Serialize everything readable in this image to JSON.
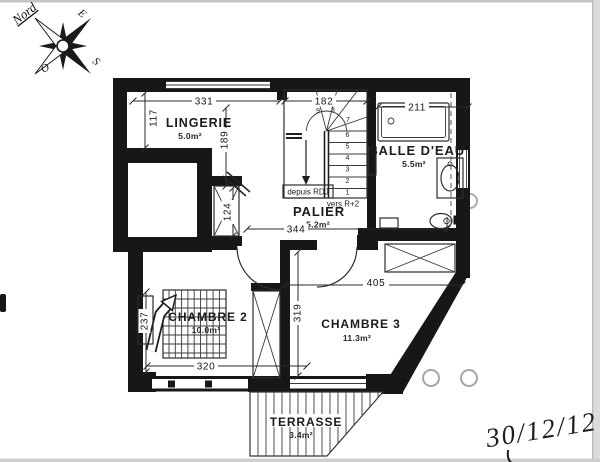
{
  "compass": {
    "north": "Nord",
    "east": "E",
    "south": "S",
    "west": "O"
  },
  "rooms": {
    "lingerie": {
      "name": "LINGERIE",
      "area": "5.0m²"
    },
    "salle_eau": {
      "name": "SALLE D'EAU",
      "area": "5.5m²"
    },
    "palier": {
      "name": "PALIER",
      "area": "5.2m²"
    },
    "chambre2": {
      "name": "CHAMBRE 2",
      "area": "10.0m²"
    },
    "chambre3": {
      "name": "CHAMBRE 3",
      "area": "11.3m²"
    },
    "terrasse": {
      "name": "TERRASSE",
      "area": "3.4m²"
    }
  },
  "dims": {
    "lingerie_width": "331",
    "lingerie_left": "117",
    "lingerie_right": "189",
    "stairs_width": "182",
    "shower_width": "211",
    "duct_height": "124",
    "palier_width": "344",
    "chambre3_width": "405",
    "chambre3_height": "319",
    "chambre2_width": "320",
    "chambre2_height": "237"
  },
  "stairs": {
    "from_label": "depuis RDJ",
    "to_label": "vers R+2",
    "steps": [
      "1",
      "2",
      "3",
      "4",
      "5",
      "6",
      "7",
      "8",
      "9"
    ]
  },
  "annotations": {
    "date": "30/12/12"
  },
  "colors": {
    "wall": "#171717",
    "line": "#2d2d2d"
  }
}
